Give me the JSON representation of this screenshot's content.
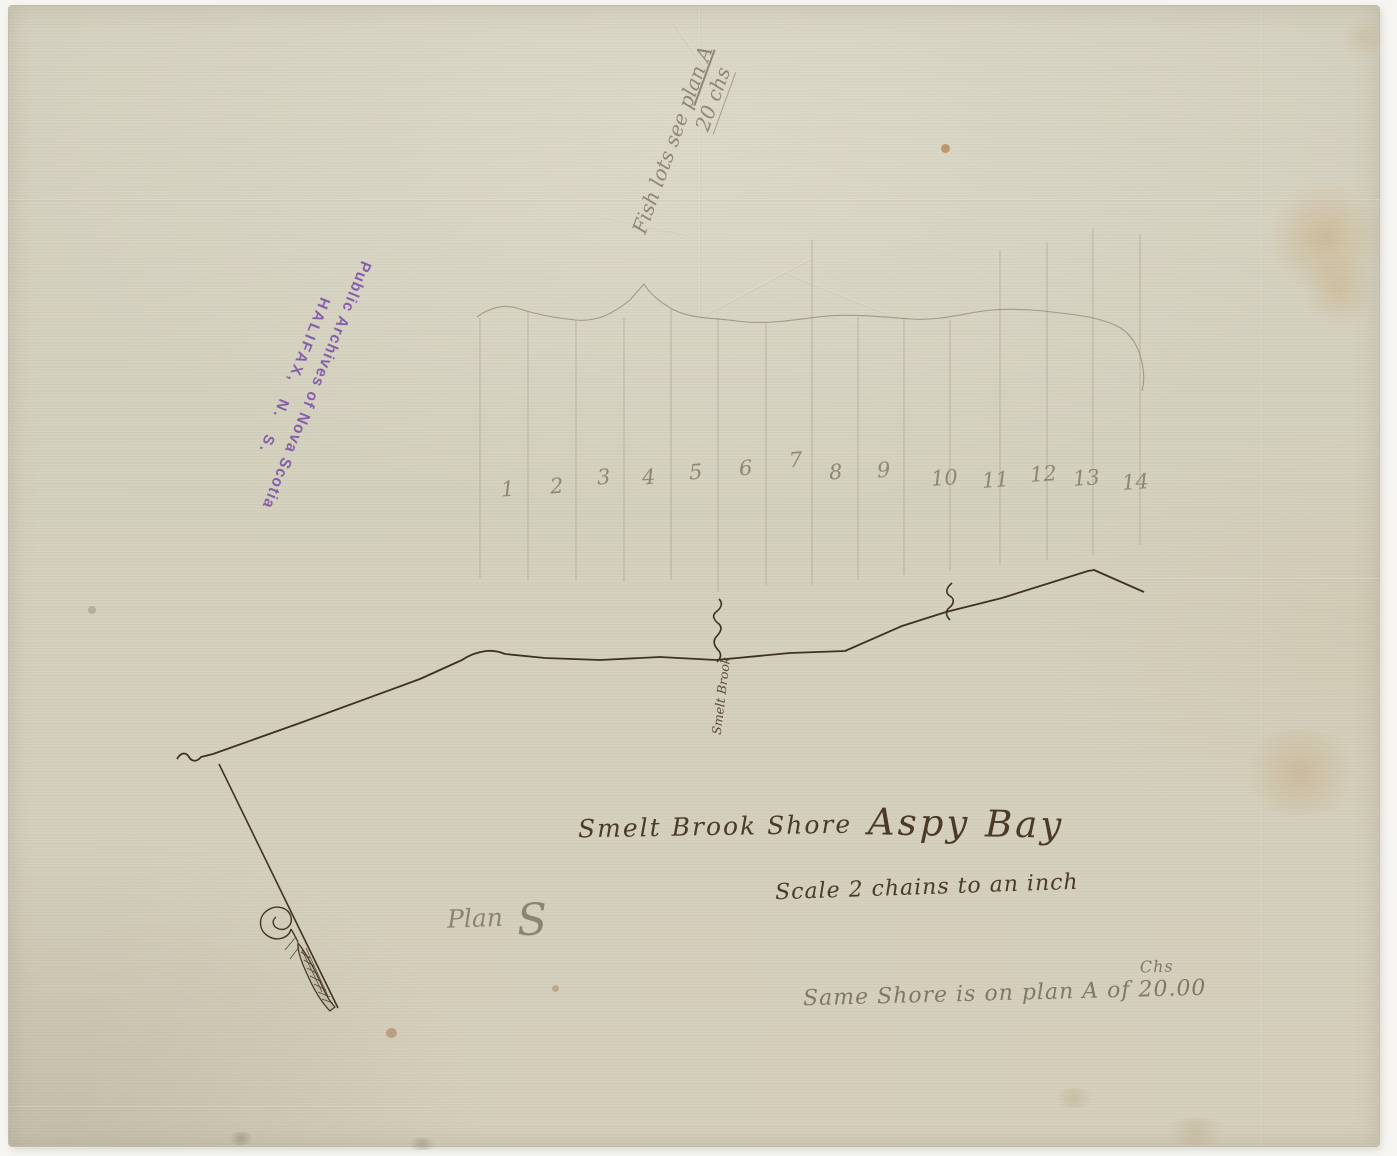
{
  "document": {
    "type": "archival survey plan",
    "shore_title": "Smelt Brook Shore",
    "bay_title": "Aspy Bay",
    "scale_note": "Scale 2 chains to an inch",
    "plan_word": "Plan",
    "plan_letter": "S"
  },
  "stamp": {
    "line1": "Public Archives of Nova Scotia",
    "line2": "HALIFAX, N. S.",
    "color": "#7b50a7"
  },
  "annotations": {
    "fish_note_line1_prefix": "Fish lots see ",
    "fish_note_line1_underlined": "plan A",
    "fish_note_line2": "20 chs",
    "same_shore_note": "Same Shore is on plan A of ",
    "same_shore_value": "20.00",
    "same_shore_superscript": "Chs",
    "brook_label": "Smelt Brook"
  },
  "lots": {
    "numbers": [
      "1",
      "2",
      "3",
      "4",
      "5",
      "6",
      "7",
      "8",
      "9",
      "10",
      "11",
      "12",
      "13",
      "14"
    ]
  },
  "colors": {
    "paper": "#d6d2c0",
    "ink": "#3f3122",
    "pencil": "#8d8776",
    "stamp_purple": "#7b50a7"
  }
}
